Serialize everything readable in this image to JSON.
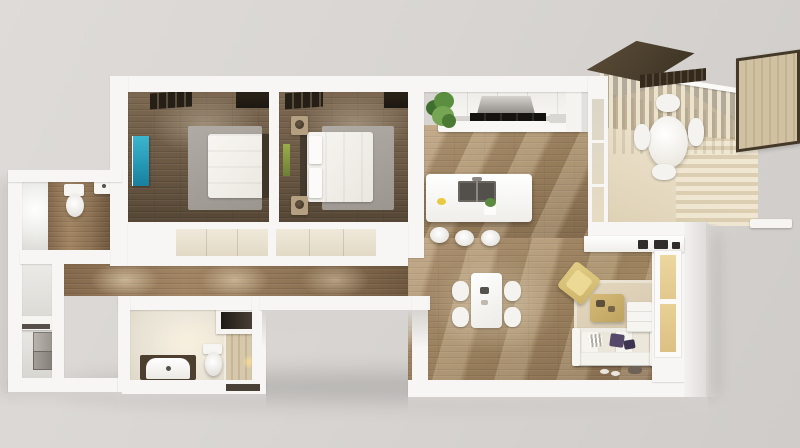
{
  "scene": {
    "type": "3d-floorplan-render",
    "description": "Isometric top-down cutaway rendering of a two-bedroom apartment with open kitchen/living area, two bathrooms, hallway, utility closets and a furnished balcony",
    "text_content": "none (image contains no text)",
    "background": "light gray studio backdrop"
  },
  "palette": {
    "background": "#d8d5d2",
    "wall_white": "#f7f6f4",
    "bedroom_wood": "#6b5944",
    "hallway_wood": "#8d7254",
    "kitchen_wood": "#a08560",
    "deck_wood": "#ece1cb",
    "bedroom_rug_gray": "#a6a19a",
    "living_rug_beige": "#dccfb6",
    "teal_wall_art": "#2fa9c6",
    "green_wall_art": "#7e923f",
    "gold_armchair": "#d9c177",
    "gold_ottoman": "#c9ae6b",
    "purple_cushion": "#564869",
    "window_blind_dark": "#261f17",
    "canopy_brown": "#4a3e2d",
    "privacy_screen_tan": "#cfc1a1",
    "closet_cream": "#e8e1cf",
    "appliance_black": "#15130f",
    "shower_marble": "#cbbda0",
    "window_glow": "#e8d59d"
  },
  "rooms": [
    {
      "id": "bedroom-1",
      "label": "Bedroom 1",
      "floor": "dark wood",
      "furniture": [
        "double bed with white duvet",
        "dark headboard",
        "gray area rug",
        "teal wall art",
        "dark window blinds",
        "cream closet front"
      ]
    },
    {
      "id": "bedroom-2",
      "label": "Bedroom 2",
      "floor": "dark wood",
      "furniture": [
        "double bed with white duvet and pillows",
        "dark headboard",
        "two tan nightstands with lamps",
        "gray area rug",
        "green wall art",
        "dark window blinds",
        "cream closet front"
      ]
    },
    {
      "id": "kitchen",
      "label": "Kitchen",
      "floor": "medium wood",
      "furniture": [
        "upper cabinet run",
        "extractor hood",
        "black cooktop strip",
        "tall cabinet / fridge",
        "potted plant",
        "white island with double sink",
        "three white bar stools"
      ]
    },
    {
      "id": "dining-area",
      "label": "Dining area",
      "floor": "medium wood",
      "furniture": [
        "white rectangular table",
        "four white chairs"
      ]
    },
    {
      "id": "living-room",
      "label": "Living room",
      "floor": "medium wood",
      "furniture": [
        "media sideboard with devices",
        "white sofa with striped and purple cushions",
        "gold armchair",
        "gold ottoman coffee table",
        "white side cabinet",
        "beige rug",
        "window with warm light",
        "slippers"
      ]
    },
    {
      "id": "hallway",
      "label": "Hallway",
      "floor": "medium wood",
      "furniture": [
        "ceiling light pools"
      ]
    },
    {
      "id": "bathroom",
      "label": "Bathroom",
      "floor": "cream tile",
      "furniture": [
        "vanity with scalloped basin",
        "toilet",
        "marble walk-in shower",
        "dark wall niche",
        "candle",
        "dark floor mat"
      ]
    },
    {
      "id": "wc",
      "label": "Guest WC",
      "floor": "wood + white tile",
      "furniture": [
        "toilet with tank",
        "wall-hung sink"
      ]
    },
    {
      "id": "utility-closet",
      "label": "Utility closets",
      "floor": "white",
      "furniture": [
        "stacked washer-dryer",
        "white shelf with slot"
      ]
    },
    {
      "id": "balcony",
      "label": "Balcony",
      "floor": "light deck boards",
      "furniture": [
        "vertical slat railing with handrail",
        "dark brown canopy panel",
        "tan privacy screen with dark frame",
        "round white table",
        "four white chairs",
        "white ledge"
      ]
    }
  ]
}
